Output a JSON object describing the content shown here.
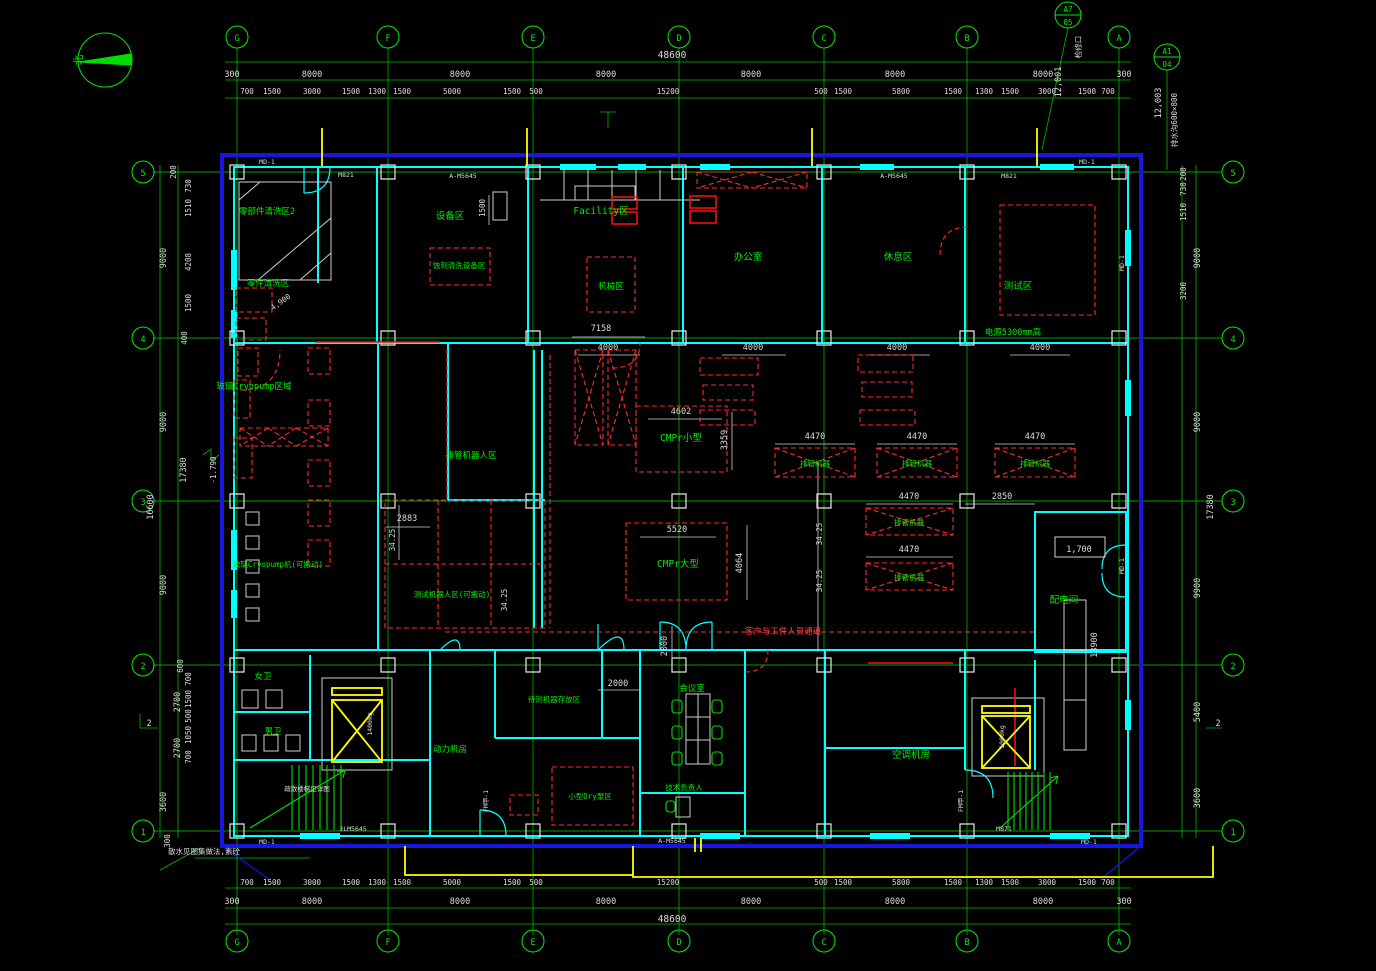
{
  "compass": {
    "north": "北"
  },
  "grid": {
    "cols": [
      "G",
      "F",
      "E",
      "D",
      "C",
      "B",
      "A"
    ],
    "rows": [
      "5",
      "4",
      "3",
      "2",
      "1"
    ]
  },
  "detail": {
    "b1_top": "A7",
    "b1_bot": "05",
    "b2_top": "A1",
    "b2_bot": "04"
  },
  "dims": {
    "total": "48600",
    "edge": "300",
    "bays_top": [
      "8000",
      "8000",
      "8000",
      "8000",
      "8000",
      "8000"
    ],
    "top_sub": [
      "700",
      "1500",
      "3000",
      "1500",
      "1300",
      "1500",
      "5000",
      "1500",
      "500",
      "15200",
      "500",
      "1500",
      "5800",
      "1500",
      "1300",
      "1500",
      "3000",
      "1500",
      "700"
    ],
    "left_bays": [
      "9000",
      "9000",
      "9000"
    ],
    "left_lower": [
      "2700",
      "2700",
      "3600",
      "300"
    ],
    "left_totals": [
      "16600",
      "17380"
    ],
    "left_sub": [
      "200",
      "730",
      "1510",
      "4208",
      "1500",
      "400",
      "600",
      "700",
      "1500",
      "500",
      "1050",
      "700"
    ],
    "right_bays": [
      "9000",
      "9000",
      "9900",
      "5400",
      "3600"
    ],
    "right_sub": [
      "200",
      "730",
      "1510",
      "3200"
    ],
    "right_total": "17380",
    "inner": {
      "w7158": "7158",
      "w4000": "4000",
      "w4602": "4602",
      "w3359": "3359",
      "w5520": "5520",
      "w4064": "4064",
      "w4470": "4470",
      "w2850": "2850",
      "w1700": "1,700",
      "w13900": "13900",
      "w2000": "2000",
      "w2883": "2883",
      "w3425": "34.25",
      "w1500": "1500",
      "w4900": "4,900",
      "w12001": "12,001",
      "w12003": "12,003"
    }
  },
  "rooms": {
    "parts_wash2": "零部件清洗区2",
    "parts_wash": "零件清洗区",
    "equip": "设备区",
    "etch": "蚀刻清洗设备区",
    "facility": "Facility区",
    "mech": "机械区",
    "office": "办公室",
    "rest": "休息区",
    "test": "测试区",
    "test_power": "电源5300mm高",
    "cryo_zone": "玻璃Cryopump区域",
    "cryo_mobile": "玻璃Cryopump机(可搬动)",
    "pipe_robot_zone": "排管机器人区",
    "test_robot_zone": "测试机器人区(可搬动)",
    "cmpr_small": "CMPr小型",
    "cmpr_large": "CMPr大型",
    "pipe_robot": "排管机器",
    "power_room": "配电间",
    "toilet_w": "女卫",
    "toilet_m": "男卫",
    "meeting": "会议室",
    "tech_lead": "技术负责人",
    "staging": "待测机器存放区",
    "dry_pump": "小型Dry泵区",
    "hvac": "空调机房",
    "power_mech": "动力机房",
    "corridor": "客户与工件人员通道",
    "stair_note": "疏散楼梯见详图"
  },
  "annotations": {
    "drain": "排水沟600×800",
    "access": "检修口",
    "splash": "散水见图集做法,素砼",
    "level": "-1.790",
    "sec2": "2"
  },
  "tags": {
    "md1": "MD-1",
    "m821": "M821",
    "am5645": "A-M5645",
    "jlm": "JLM5645",
    "m871": "M871",
    "fmj1": "FM甲-1",
    "lift1": "1400kg",
    "lift2": "1000kg"
  }
}
